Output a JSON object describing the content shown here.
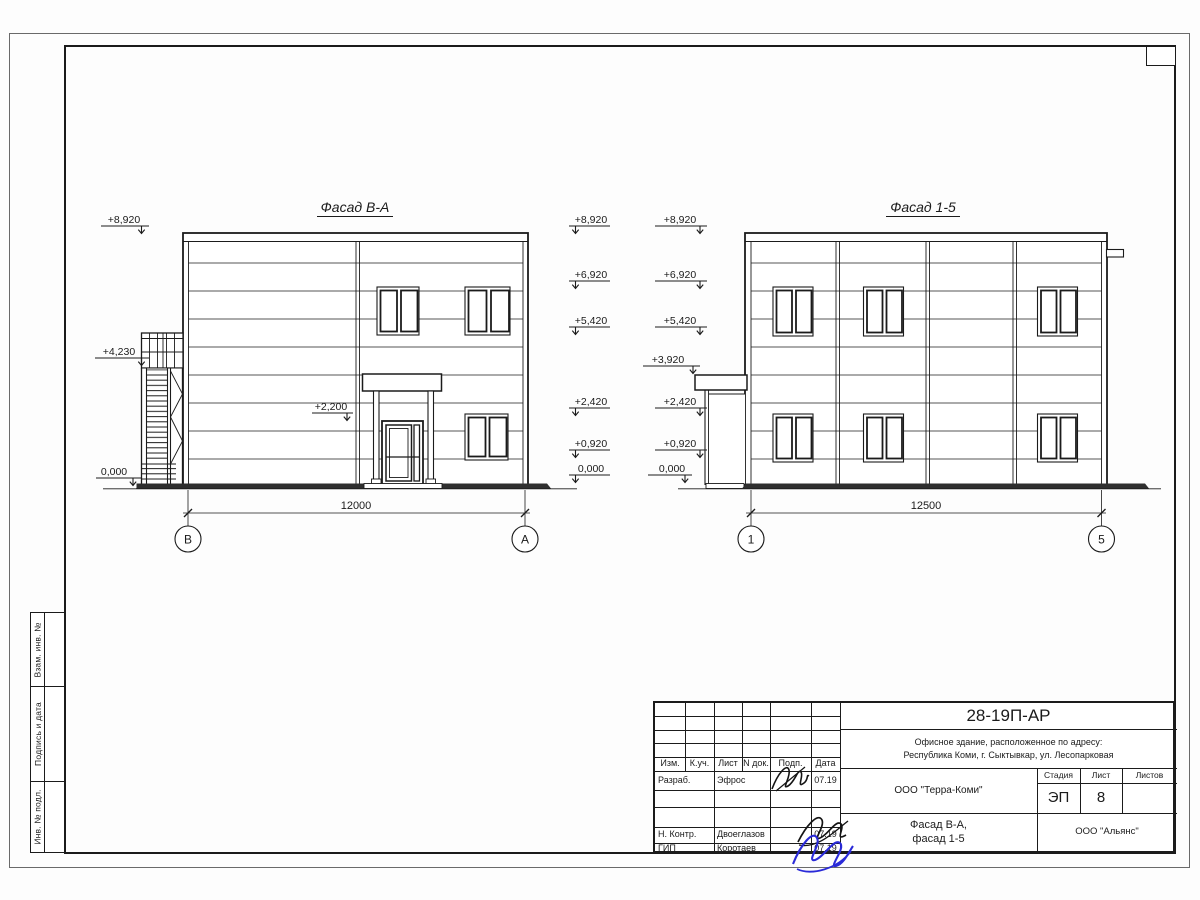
{
  "margin_stamps": {
    "box1": "Взам. инв. №",
    "box2": "Подпись и дата",
    "box3": "Инв. № подл."
  },
  "facade_left": {
    "title": "Фасад В-А",
    "marks_outer": [
      "+8,920",
      "+4,230",
      "0,000"
    ],
    "marks_inner": [
      "+8,920",
      "+6,920",
      "+5,420",
      "+2,420",
      "+0,920",
      "0,000"
    ],
    "mark_canopy": "+2,200",
    "dimension": "12000",
    "axis_left": "В",
    "axis_right": "А"
  },
  "facade_right": {
    "title": "Фасад 1-5",
    "marks": [
      "+8,920",
      "+6,920",
      "+5,420",
      "+3,920",
      "+2,420",
      "+0,920",
      "0,000"
    ],
    "dimension": "12500",
    "axis_left": "1",
    "axis_right": "5"
  },
  "title_block": {
    "doc_number": "28-19П-АР",
    "desc_line1": "Офисное здание, расположенное по адресу:",
    "desc_line2": "Республика Коми, г. Сыктывкар, ул. Лесопарковая",
    "col_headers": [
      "Изм.",
      "К.уч.",
      "Лист",
      "N док.",
      "Подп.",
      "Дата"
    ],
    "row_razrab_role": "Разраб.",
    "row_razrab_name": "Эфрос",
    "row_razrab_date": "07.19",
    "row_nkontr_role": "Н. Контр.",
    "row_nkontr_name": "Двоеглазов",
    "row_nkontr_date": "07.19",
    "row_gip_role": "ГИП",
    "row_gip_name": "Коротаев",
    "row_gip_date": "07.19",
    "company": "ООО \"Терра-Коми\"",
    "stage_label": "Стадия",
    "sheet_label": "Лист",
    "sheets_label": "Листов",
    "stage_value": "ЭП",
    "sheet_value": "8",
    "sheets_value": "",
    "drawing_title1": "Фасад В-А,",
    "drawing_title2": "фасад 1-5",
    "contractor": "ООО \"Альянс\"",
    "colors": {
      "line": "#1b1b1b",
      "signature_blue": "#2a2ad8"
    }
  }
}
